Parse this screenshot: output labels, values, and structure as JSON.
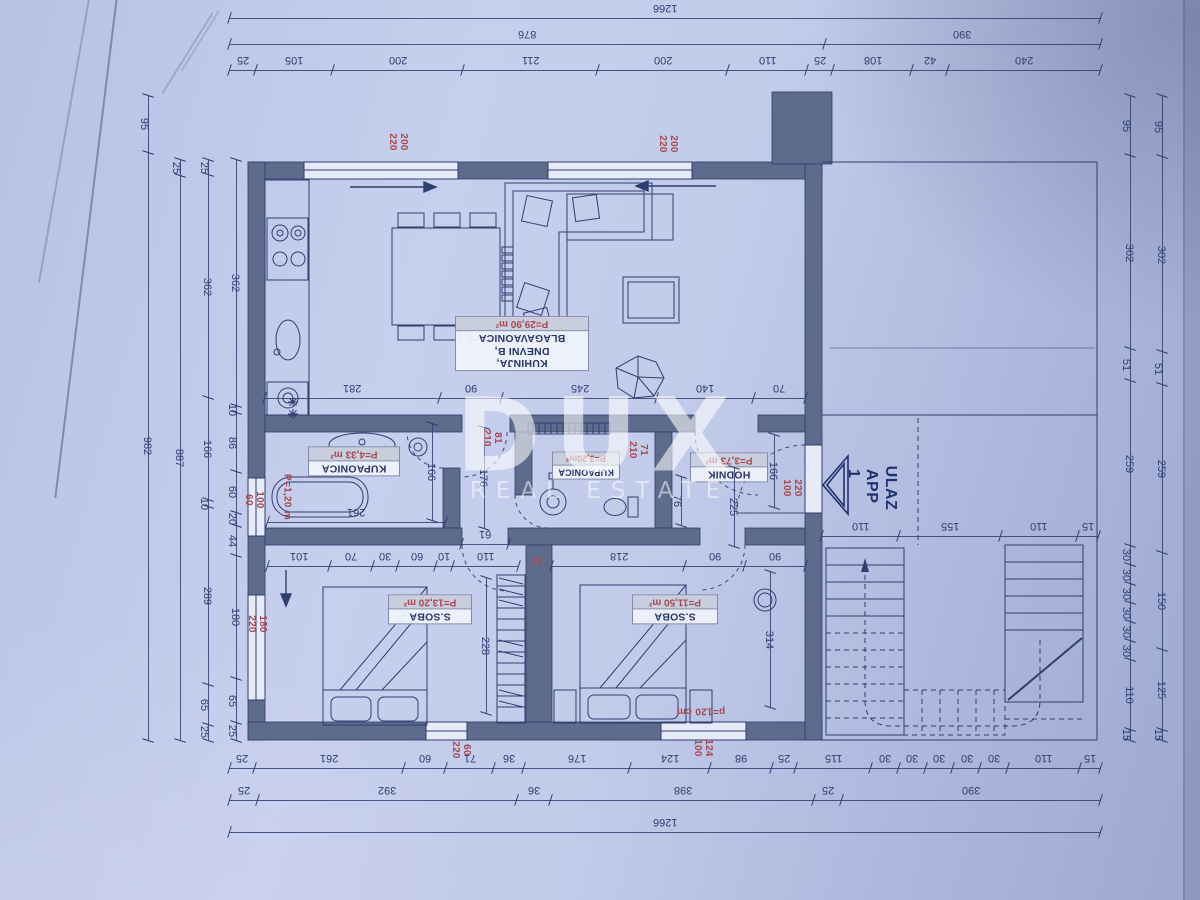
{
  "watermark": {
    "brand": "DUX",
    "tagline": "REAL ESTATE"
  },
  "plan": {
    "colors": {
      "paper": "#bfc9ea",
      "line": "#2e3e6f",
      "wall": "#5d6b8c",
      "red": "#a8494c",
      "watermark": "#ffffff"
    },
    "rooms": [
      {
        "id": "kitchen",
        "lines": [
          "KUHINJA,",
          "DNEVNI B,",
          "BLAGAVAONICA"
        ],
        "area": "P=29,90 m²"
      },
      {
        "id": "bathroom-main",
        "lines": [
          "KUPAONICA"
        ],
        "area": "P=4,33 m²"
      },
      {
        "id": "bathroom-small",
        "lines": [
          "KUPAONICA"
        ],
        "area": "P=3,20m²"
      },
      {
        "id": "hallway",
        "lines": [
          "HODNIK"
        ],
        "area": "P=3,73 m²"
      },
      {
        "id": "bedroom-left",
        "lines": [
          "S.SOBA"
        ],
        "area": "P=13,20 m²"
      },
      {
        "id": "bedroom-right",
        "lines": [
          "S.SOBA"
        ],
        "area": "P=11,50 m²"
      }
    ],
    "entrance": {
      "line1": "ULAZ",
      "line2": "APP 1"
    },
    "chains": {
      "top_total": [
        "1266"
      ],
      "top_mid": [
        "876",
        "390"
      ],
      "top_detail": [
        "25",
        "105",
        "200",
        "211",
        "200",
        "110",
        "25",
        "108",
        "42",
        "240"
      ],
      "bottom_detail": [
        "25",
        "261",
        "60",
        "71",
        "36",
        "176",
        "124",
        "98",
        "25",
        "115",
        "30",
        "30",
        "30",
        "30",
        "30",
        "110",
        "15"
      ],
      "bottom_mid": [
        "25",
        "392",
        "36",
        "398",
        "25",
        "390"
      ],
      "bottom_total": [
        "1266"
      ],
      "left_outer": [
        "95",
        "982"
      ],
      "left_mid": [
        "25",
        "887"
      ],
      "left_inner": [
        "25",
        "362",
        "166",
        "10",
        "289",
        "65",
        "25"
      ],
      "left_wall": [
        "362",
        "10",
        "86",
        "60",
        "20",
        "44",
        "180",
        "65",
        "25"
      ],
      "right_inner": [
        "95",
        "302",
        "51",
        "259",
        "30",
        "30",
        "30",
        "30",
        "30",
        "30",
        "110",
        "15"
      ],
      "right_outer": [
        "95",
        "302",
        "51",
        "259",
        "150",
        "125",
        "15"
      ],
      "mid_room": [
        "281",
        "90",
        "245",
        "140",
        "70"
      ],
      "bath_main_width": [
        "261"
      ],
      "bath_main_height": [
        "166"
      ],
      "corridor_height": [
        "176"
      ],
      "corridor_width": [
        "61"
      ],
      "bedroom_left_top": [
        "101",
        "70",
        "30",
        "60",
        "10",
        "110"
      ],
      "bedroom_right_top": [
        "218",
        "90",
        "90"
      ],
      "bedroom_left_height": [
        "228"
      ],
      "bedroom_right_height": [
        "314"
      ],
      "hall_height": [
        "166"
      ],
      "hall_inner": [
        "225"
      ],
      "hall_small": [
        "76"
      ],
      "stairs_bottom": [
        "110",
        "155",
        "110",
        "15"
      ]
    },
    "red_labels": {
      "window_top_left": [
        "200",
        "220"
      ],
      "window_top_right": [
        "200",
        "220"
      ],
      "door_corridor": [
        "81",
        "210"
      ],
      "door_bath_small": [
        "71",
        "210"
      ],
      "door_entrance": [
        "220",
        "100"
      ],
      "window_left_small": [
        "100",
        "60"
      ],
      "window_left_large": [
        "180",
        "220"
      ],
      "window_bottom_left": [
        "60",
        "220"
      ],
      "window_bottom_right": [
        "124",
        "100"
      ],
      "bed_width": [
        "p=120 cm"
      ],
      "wall_gap": [
        "47"
      ],
      "bathtub_length": [
        "P=1,20 m"
      ]
    }
  }
}
